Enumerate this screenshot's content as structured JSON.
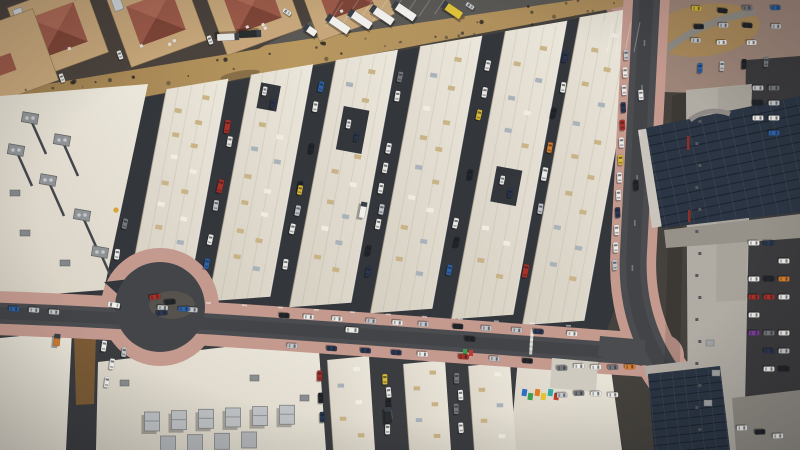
{
  "meta": {
    "description": "aerial-photo-industrial-warehouse-district",
    "width": 800,
    "height": 450
  },
  "palette": {
    "base": "#45423d",
    "alley": "#33363b",
    "bottomground": "#3a3c40",
    "road": "#4b4c50",
    "bulb": "#434549",
    "island": "#56524d",
    "pink": "#c49a8f",
    "sand1": "#9a7c4e",
    "sand2": "#b8985f",
    "sand3": "#a8895a",
    "lot": "#5a5854",
    "resground": "#4a423c",
    "plaza": "#9c8478",
    "wall": "#c6a67a",
    "wallline": "#8a744f",
    "redroof": "#9b5a49",
    "redroofhi": "#ad6a56",
    "redrooflo": "#7e4537",
    "rooflo": "#d5cfc2",
    "roofhi": "#ece7db",
    "skybeige": "#c7b184",
    "skygray": "#a7b0b8",
    "skywhite": "#f0ece2",
    "solar": "#2b3543",
    "solarline": "#1a232e",
    "solarline2": "#3a4754",
    "graybld": "#b0aca4",
    "grayroof": "#96928a",
    "grayroof2": "#8e8a83",
    "lotdark": "#3b3b3d",
    "brown": "#7c5c36",
    "hvac": "#bfc2c4",
    "truckwhite": "#f0efec",
    "truckyellow": "#dfc23a",
    "orange": "#d07a2e",
    "redcar": "#a8312a",
    "bluecar": "#2f64a8",
    "purplecar": "#7b4194"
  },
  "carColors": [
    [
      "#eceae6",
      40
    ],
    [
      "#c3c6c8",
      15
    ],
    [
      "#23262a",
      15
    ],
    [
      "#2c3852",
      7
    ],
    [
      "#a8312a",
      5
    ],
    [
      "#2f64a8",
      6
    ],
    [
      "#75797c",
      7
    ],
    [
      "#d8b93a",
      2
    ],
    [
      "#7b4194",
      1
    ],
    [
      "#d77f2f",
      2
    ]
  ],
  "scene": {
    "residential_buildings": 5,
    "trucks_top_lot": 8,
    "warehouse_strips_main": 6,
    "warehouse_strips_bottom": 3,
    "alley_car_counts": [
      6,
      9,
      10,
      10,
      9,
      8
    ],
    "skylights_per_strip": 15,
    "road_cars_top": 15,
    "road_cars_bottom": 8,
    "road_cars_left_segment": 3,
    "right_road_cars": 14,
    "plaza_cars": 11,
    "dealer_rows_mid": 8,
    "dealer_rows_top": 4,
    "junction_lot_cars": 9,
    "loop_island_cars": 4,
    "bottom_alley_car_counts": [
      3,
      5,
      4
    ],
    "hvac_clusters_left_roof": 6,
    "hvac_units_bottom_roof": 10,
    "tarp_colors": [
      "#2e6fc2",
      "#3f9b4f",
      "#e07b28",
      "#e0c22e",
      "#2ea8a0",
      "#c23b2e"
    ]
  }
}
